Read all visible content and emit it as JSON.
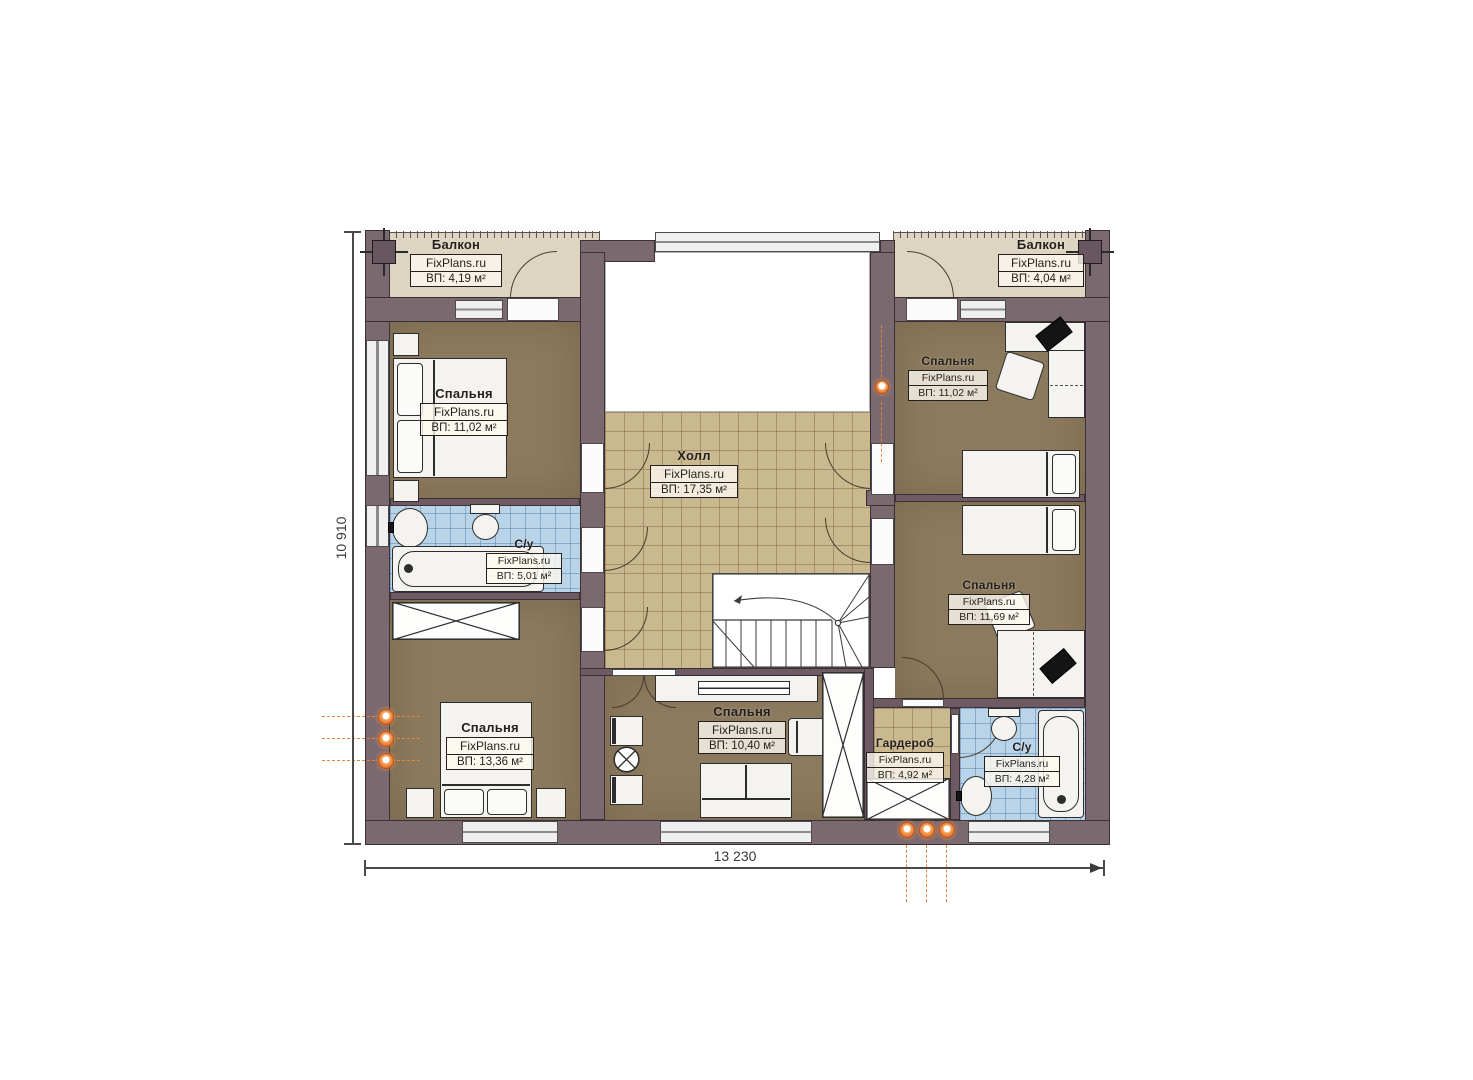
{
  "plan": {
    "type": "floor-plan",
    "floor_description": "second floor plan with bedrooms, hall, bathrooms, wardrobe and two balconies",
    "language": "ru"
  },
  "watermark": "FixPlans.ru",
  "dimensions": {
    "width_label": "13 230",
    "height_label": "10 910"
  },
  "rooms": [
    {
      "id": "balcony-left",
      "name": "Балкон",
      "area": "ВП: 4,19 м²"
    },
    {
      "id": "balcony-right",
      "name": "Балкон",
      "area": "ВП: 4,04 м²"
    },
    {
      "id": "bedroom-top-left",
      "name": "Спальня",
      "area": "ВП: 11,02 м²"
    },
    {
      "id": "bathroom-left",
      "name": "С/у",
      "area": "ВП: 5,01 м²"
    },
    {
      "id": "bedroom-bottom-left",
      "name": "Спальня",
      "area": "ВП: 13,36 м²"
    },
    {
      "id": "hall",
      "name": "Холл",
      "area": "ВП: 17,35 м²"
    },
    {
      "id": "bedroom-top-right",
      "name": "Спальня",
      "area": "ВП: 11,02 м²"
    },
    {
      "id": "bedroom-mid-right",
      "name": "Спальня",
      "area": "ВП: 11,69 м²"
    },
    {
      "id": "bedroom-bottom-center",
      "name": "Спальня",
      "area": "ВП: 10,40 м²"
    },
    {
      "id": "wardrobe",
      "name": "Гардероб",
      "area": "ВП: 4,92 м²"
    },
    {
      "id": "bathroom-right",
      "name": "С/у",
      "area": "ВП: 4,28 м²"
    }
  ],
  "colors": {
    "wall": "#7b6970",
    "bedroom_floor": "#8c7a5e",
    "hall_tile": "#cab88e",
    "bathroom_tile": "#b9d4e9",
    "balcony_floor": "#ddd4c2",
    "heating_accent": "#e8833a"
  }
}
